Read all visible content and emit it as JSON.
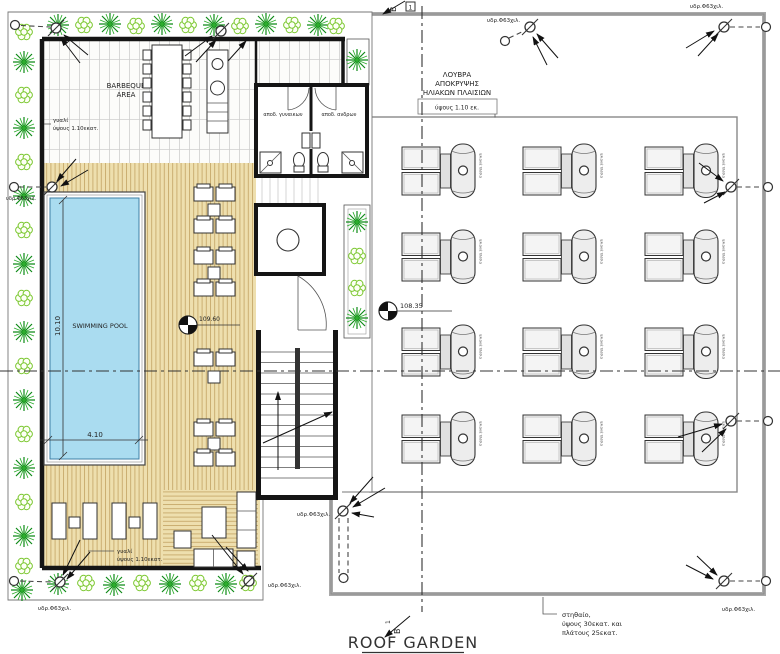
{
  "title": "ROOF GARDEN",
  "areas": {
    "barbeque_line1": "BARBEQUE",
    "barbeque_line2": "AREA",
    "swimming_pool": "SWIMMING POOL",
    "wc_women": "αποδ. γυναικων",
    "wc_men": "αποδ. ανδρων"
  },
  "dimensions": {
    "pool_length": "10.10",
    "pool_width": "4.10"
  },
  "levels": {
    "deck_level": "109.60",
    "roof_level": "108.35"
  },
  "notes": {
    "glass_line1": "γυαλί",
    "glass_line2": "ύψους 1.10εκατ.",
    "louver_line1": "ΛΟΥΒΡΑ",
    "louver_line2": "ΑΠΟΚΡΥΨΗΣ",
    "louver_line3": "ΗΛΙΑΚΩΝ ΠΛΑΙΣΙΩΝ",
    "louver_height": "ύψους 1.10 εκ.",
    "drain_label": "υδρ.Φ63χιλ.",
    "parapet_line1": "στηθαίο,",
    "parapet_line2": "ύψους 30εκατ. και",
    "parapet_line3": "πλάτους 25εκατ.",
    "solar_tank_label": "ηλιακά πλ/σια"
  },
  "section_marker": {
    "letter": "Β",
    "number": "1"
  },
  "colors": {
    "pool_water": "#aadcf0",
    "deck": "#eedfae",
    "deck_stripe": "#c7a96a",
    "plant_dark": "#0f8a18",
    "plant_light": "#7cc832",
    "wall": "#151515"
  }
}
